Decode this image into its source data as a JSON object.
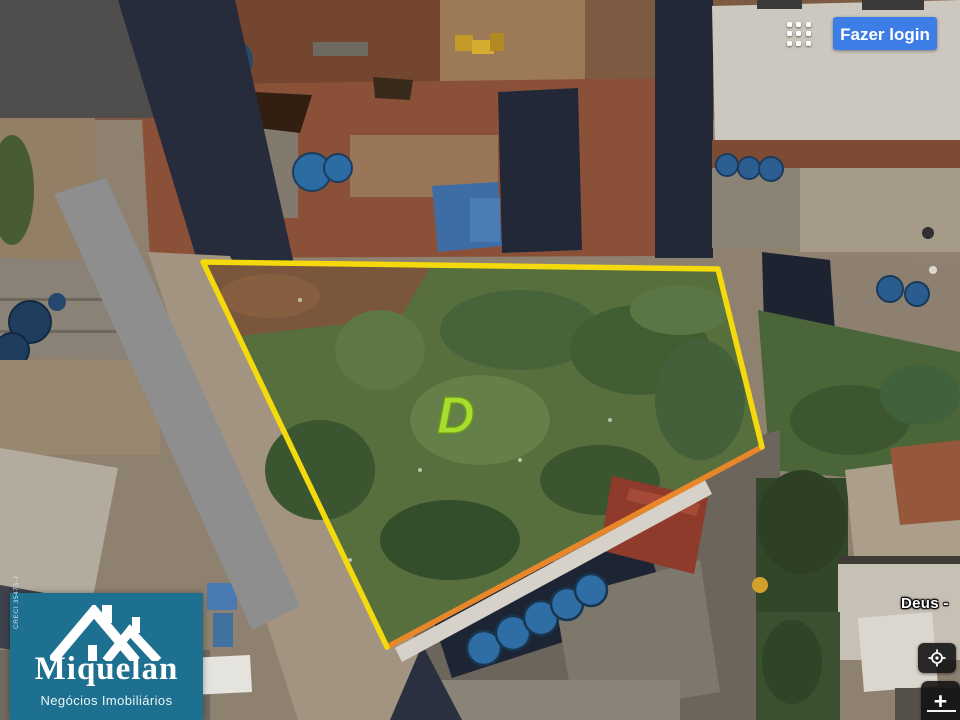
{
  "header": {
    "login_label": "Fazer login"
  },
  "plot": {
    "label": "D",
    "label_color": "#a8dd30",
    "outline_color": "#f4d90c",
    "outline_secondary_color": "#e8862a"
  },
  "map_labels": {
    "street": "Deus -"
  },
  "watermark": {
    "brand": "Miquelan",
    "tagline": "Negócios Imobiliários",
    "registration": "CRECI 35473-J",
    "background_color": "#1e7090"
  },
  "controls": {
    "zoom_in_label": "+"
  },
  "colors": {
    "login_button": "#3c7de6",
    "control_button": "#101010"
  }
}
